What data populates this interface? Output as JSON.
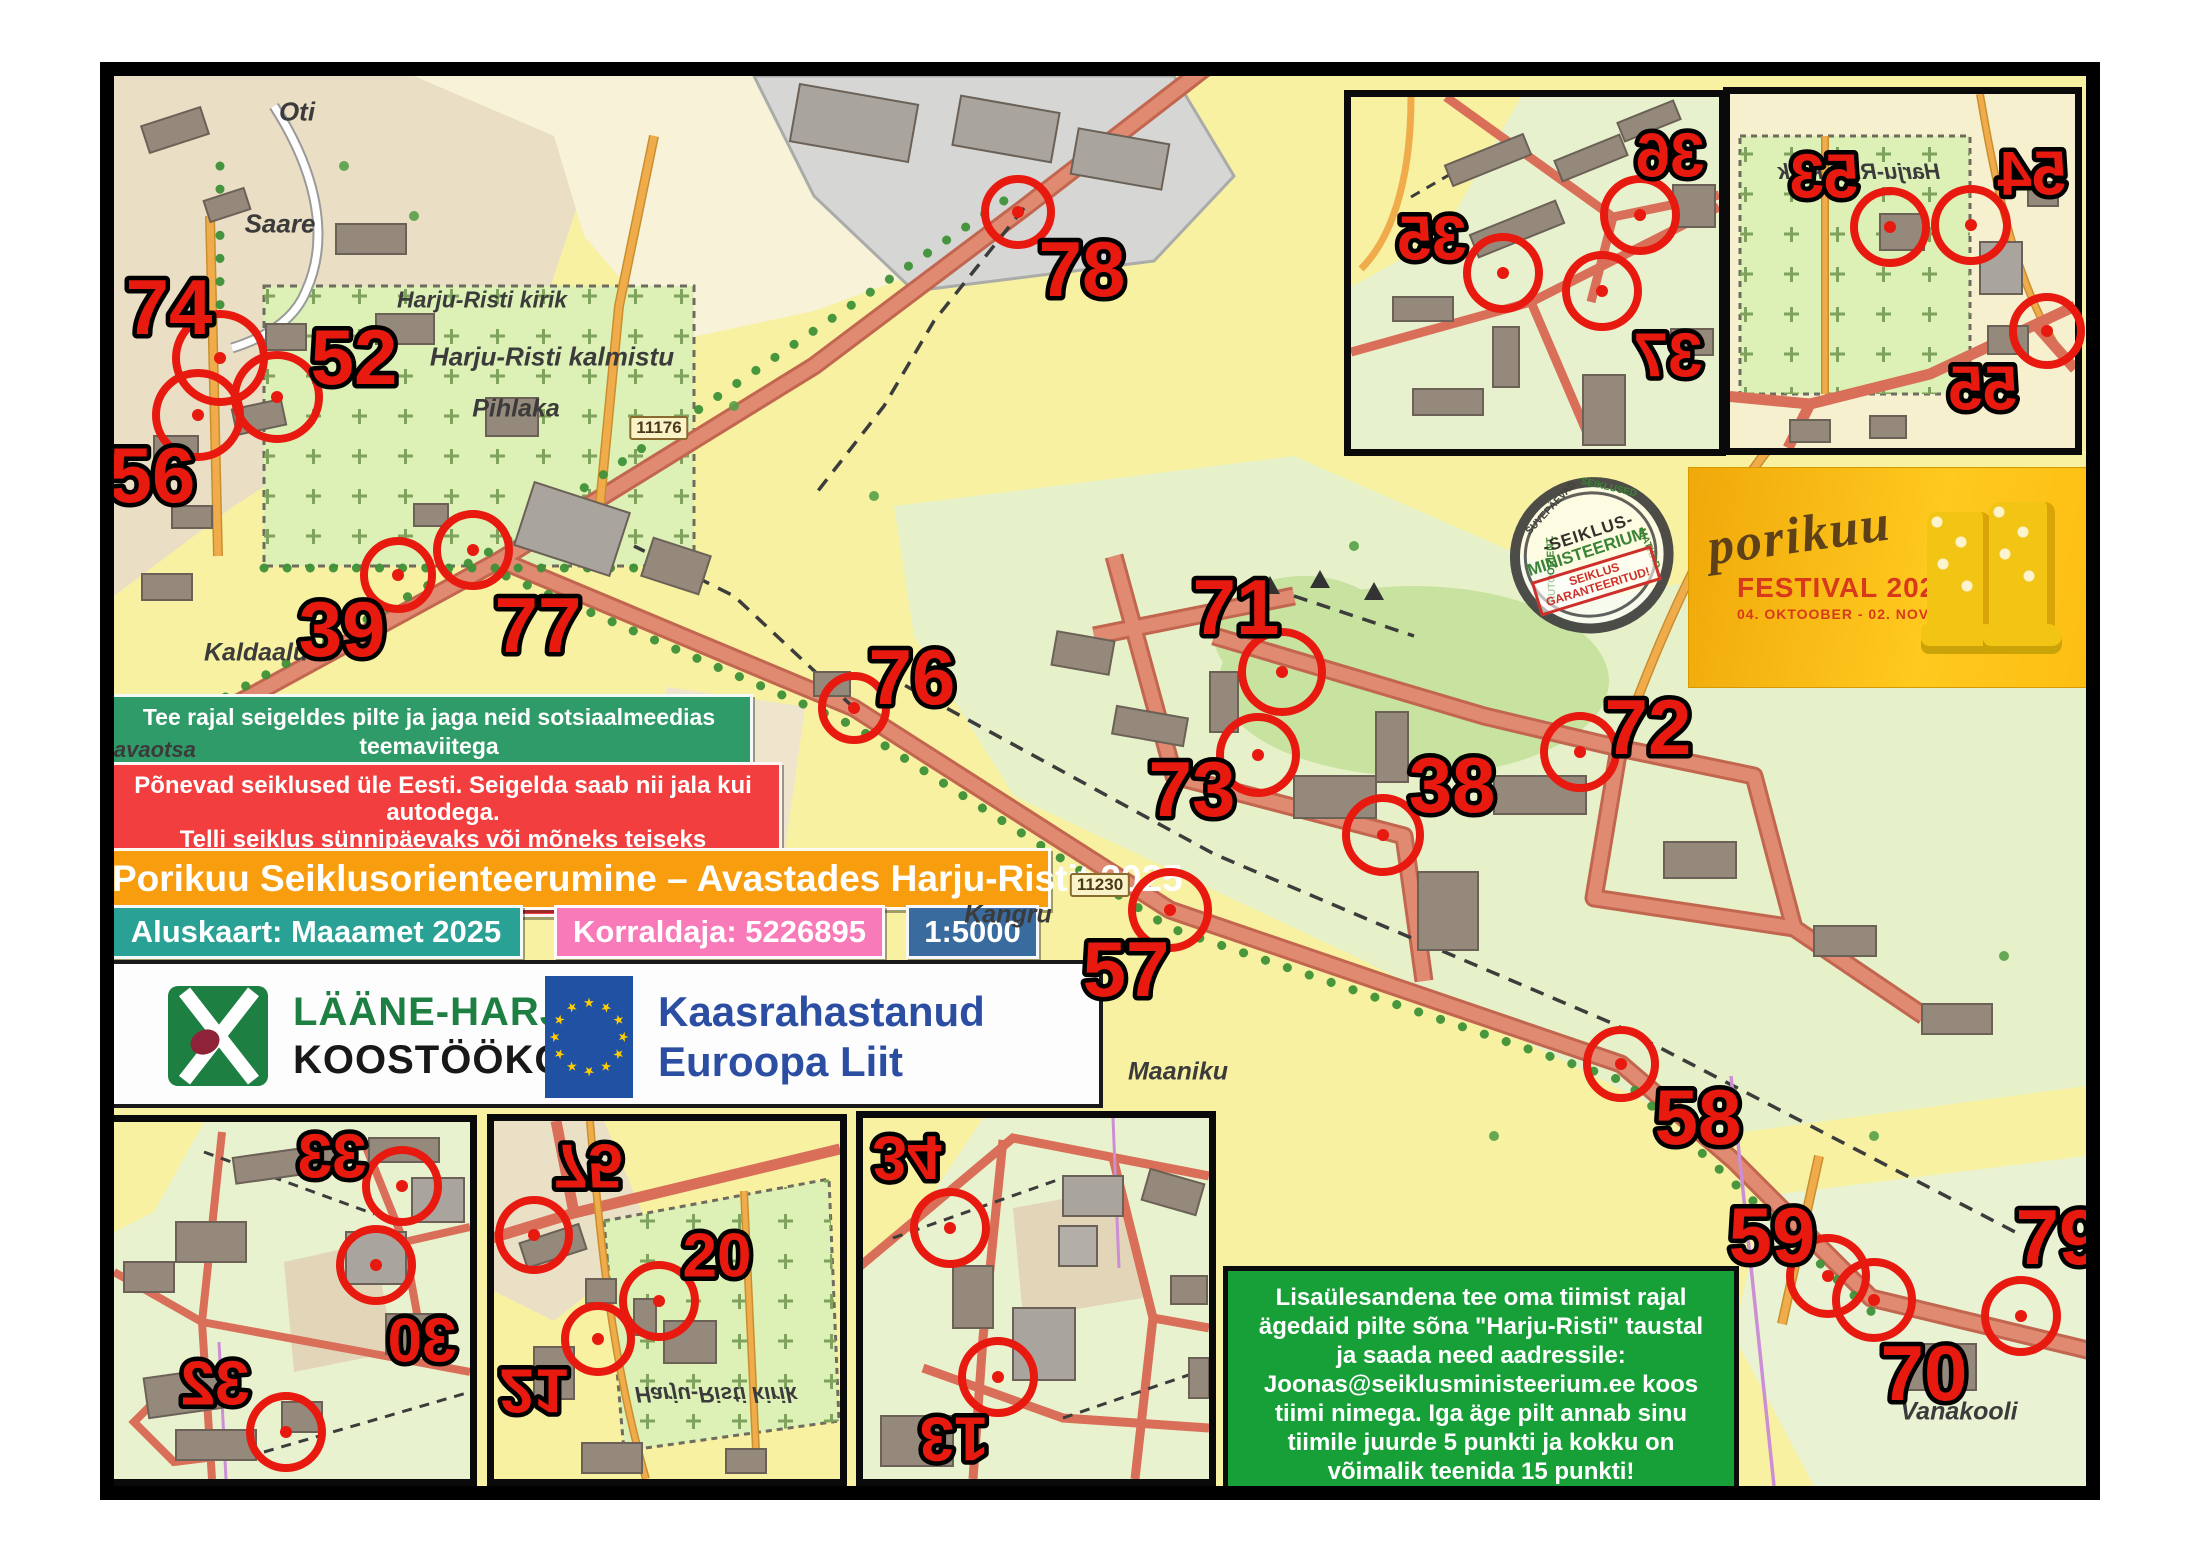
{
  "colors": {
    "control_red": "#E8190F",
    "map_yellow": "#F7F1A1",
    "forest_green": "#C8E2A0",
    "settlement_green": "#E6F1C9",
    "cemetery_green": "#DDF0B6",
    "road_salmon": "#E08A72",
    "road_orange": "#F0AC4B",
    "hashtag_box_bg": "#2F9B68",
    "promo_box_bg": "#F23E3E",
    "title_bg": "#F89D0E",
    "basemap_bg": "#29A295",
    "organizer_bg": "#F97AB8",
    "scale_bg": "#3A6B9F",
    "bonus_bg": "#17A038",
    "eu_blue": "#2151A3",
    "lhk_green": "#1E7F43",
    "festival_bg": "#FBB80B"
  },
  "boxes": {
    "hashtags": "Tee rajal seigeldes pilte ja jaga neid sotsiaalmeedias teemaviitega\n#porikuu #vasalemma #seiklusministeerium #seiklus #lääneharjuvald",
    "promo": "Põnevad seiklused üle Eesti. Seigelda saab nii jala kui autodega.\nTelli seiklus sünnipäevaks või mõneks teiseks tähtpäevaks!\nHuvi korral kirjuta: Joonas@seiklusministeerium.ee",
    "title": "Porikuu Seiklusorienteerumine – Avastades Harju-Ristit 2025",
    "basemap": "Aluskaart: Maaamet 2025",
    "organizer": "Korraldaja: 5226895",
    "scale": "1:5000",
    "bonus": "Lisaülesandena tee oma tiimist rajal\nägedaid pilte sõna \"Harju-Risti\" taustal\nja saada need aadressile:\nJoonas@seiklusministeerium.ee koos\ntiimi nimega. Iga äge pilt annab sinu\ntiimile juurde 5 punkti ja kokku on\nvõimalik teenida 15 punkti!"
  },
  "logos": {
    "lhk_line1": "LÄÄNE-HARJU",
    "lhk_line2": "KOOSTÖÖKOGU",
    "eu_line1": "Kaasrahastanud",
    "eu_line2": "Euroopa Liit"
  },
  "festival": {
    "script": "porikuu",
    "title": "FESTIVAL 2025",
    "dates": "04. OKTOOBER - 02. NOVEMBER"
  },
  "stamp": {
    "top": "-SEIKLUS-",
    "mid": "MINISTEERIUM",
    "overlay": "SEIKLUS\nGARANTEERITUD!",
    "ring_words": [
      "SUVEPÄEVAD",
      "SEIKLUSED",
      "MATKAD",
      "AUTOORIENT."
    ]
  },
  "map": {
    "labels": [
      {
        "t": "Oti",
        "x": 183,
        "y": 36,
        "s": 26
      },
      {
        "t": "Saare",
        "x": 166,
        "y": 148,
        "s": 26
      },
      {
        "t": "Harju-Risti kirik",
        "x": 368,
        "y": 224,
        "s": 23
      },
      {
        "t": "Harju-Risti kalmistu",
        "x": 438,
        "y": 281,
        "s": 26
      },
      {
        "t": "Pihlaka",
        "x": 402,
        "y": 333,
        "s": 25
      },
      {
        "t": "Kaldaaluse",
        "x": 156,
        "y": 577,
        "s": 25
      },
      {
        "t": "änavaotsa",
        "x": 28,
        "y": 674,
        "s": 22
      },
      {
        "t": "Kangru",
        "x": 894,
        "y": 839,
        "s": 25
      },
      {
        "t": "Maaniku",
        "x": 1064,
        "y": 996,
        "s": 25
      },
      {
        "t": "Vanakooli",
        "x": 1845,
        "y": 1336,
        "s": 25
      },
      {
        "t": "11176",
        "x": 545,
        "y": 352,
        "shield": true
      },
      {
        "t": "11230",
        "x": 986,
        "y": 809,
        "shield": true
      },
      {
        "t": "Harju-Risti kirik",
        "x": 1745,
        "y": 96,
        "s": 22,
        "flip": "x"
      },
      {
        "t": "Harju-Risti kirik",
        "x": 602,
        "y": 1318,
        "s": 22,
        "flip": "y"
      }
    ],
    "controls": [
      {
        "n": "74",
        "cx": 106,
        "cy": 282,
        "r": 44,
        "nx": 55,
        "ny": 230,
        "fs": 78
      },
      {
        "n": "52",
        "cx": 163,
        "cy": 321,
        "r": 42,
        "nx": 240,
        "ny": 280,
        "fs": 78
      },
      {
        "n": "56",
        "cx": 84,
        "cy": 339,
        "r": 42,
        "nx": 38,
        "ny": 398,
        "fs": 78
      },
      {
        "n": "39",
        "cx": 284,
        "cy": 499,
        "r": 34,
        "nx": 228,
        "ny": 552,
        "fs": 78
      },
      {
        "n": "77",
        "cx": 359,
        "cy": 474,
        "r": 36,
        "nx": 424,
        "ny": 548,
        "fs": 78
      },
      {
        "n": "78",
        "cx": 904,
        "cy": 136,
        "r": 33,
        "nx": 968,
        "ny": 192,
        "fs": 78
      },
      {
        "n": "76",
        "cx": 740,
        "cy": 632,
        "r": 32,
        "nx": 798,
        "ny": 600,
        "fs": 78
      },
      {
        "n": "71",
        "cx": 1168,
        "cy": 596,
        "r": 40,
        "nx": 1122,
        "ny": 530,
        "fs": 78
      },
      {
        "n": "73",
        "cx": 1144,
        "cy": 679,
        "r": 38,
        "nx": 1078,
        "ny": 712,
        "fs": 78
      },
      {
        "n": "38",
        "cx": 1269,
        "cy": 759,
        "r": 37,
        "nx": 1338,
        "ny": 708,
        "fs": 78
      },
      {
        "n": "72",
        "cx": 1466,
        "cy": 676,
        "r": 36,
        "nx": 1534,
        "ny": 650,
        "fs": 78
      },
      {
        "n": "57",
        "cx": 1056,
        "cy": 834,
        "r": 38,
        "nx": 1012,
        "ny": 892,
        "fs": 78
      },
      {
        "n": "58",
        "cx": 1507,
        "cy": 988,
        "r": 34,
        "nx": 1584,
        "ny": 1040,
        "fs": 78
      },
      {
        "n": "59",
        "cx": 1714,
        "cy": 1200,
        "r": 38,
        "nx": 1658,
        "ny": 1158,
        "fs": 78
      },
      {
        "n": "70",
        "cx": 1760,
        "cy": 1224,
        "r": 38,
        "nx": 1810,
        "ny": 1296,
        "fs": 78
      },
      {
        "n": "79",
        "cx": 1907,
        "cy": 1240,
        "r": 36,
        "nx": 1945,
        "ny": 1160,
        "fs": 78
      },
      {
        "n": "35",
        "cx": 1389,
        "cy": 197,
        "r": 36,
        "nx": 1318,
        "ny": 161,
        "fs": 62,
        "flip": "x"
      },
      {
        "n": "36",
        "cx": 1526,
        "cy": 139,
        "r": 36,
        "nx": 1556,
        "ny": 78,
        "fs": 62,
        "flip": "x"
      },
      {
        "n": "37",
        "cx": 1488,
        "cy": 215,
        "r": 36,
        "nx": 1554,
        "ny": 278,
        "fs": 62,
        "flip": "x"
      },
      {
        "n": "53",
        "cx": 1776,
        "cy": 151,
        "r": 36,
        "nx": 1710,
        "ny": 99,
        "fs": 62,
        "flip": "x"
      },
      {
        "n": "54",
        "cx": 1857,
        "cy": 149,
        "r": 36,
        "nx": 1918,
        "ny": 96,
        "fs": 62,
        "flip": "x"
      },
      {
        "n": "55",
        "cx": 1933,
        "cy": 255,
        "r": 34,
        "nx": 1869,
        "ny": 311,
        "fs": 62,
        "flip": "x"
      },
      {
        "n": "33",
        "cx": 288,
        "cy": 1110,
        "r": 36,
        "nx": 218,
        "ny": 1079,
        "fs": 62,
        "flip": "x"
      },
      {
        "n": "30",
        "cx": 262,
        "cy": 1189,
        "r": 36,
        "nx": 308,
        "ny": 1263,
        "fs": 62,
        "flip": "x"
      },
      {
        "n": "32",
        "cx": 172,
        "cy": 1356,
        "r": 36,
        "nx": 101,
        "ny": 1306,
        "fs": 62,
        "flip": "x"
      },
      {
        "n": "75",
        "cx": 420,
        "cy": 1159,
        "r": 35,
        "nx": 474,
        "ny": 1091,
        "fs": 62,
        "flip": "y"
      },
      {
        "n": "20",
        "cx": 545,
        "cy": 1225,
        "r": 36,
        "nx": 603,
        "ny": 1178,
        "fs": 62
      },
      {
        "n": "21",
        "cx": 484,
        "cy": 1263,
        "r": 33,
        "nx": 420,
        "ny": 1316,
        "fs": 62,
        "flip": "y"
      },
      {
        "n": "34",
        "cx": 836,
        "cy": 1152,
        "r": 36,
        "nx": 793,
        "ny": 1083,
        "fs": 62,
        "flip": "y"
      },
      {
        "n": "13",
        "cx": 884,
        "cy": 1301,
        "r": 36,
        "nx": 840,
        "ny": 1364,
        "fs": 62,
        "flip": "r"
      }
    ]
  }
}
